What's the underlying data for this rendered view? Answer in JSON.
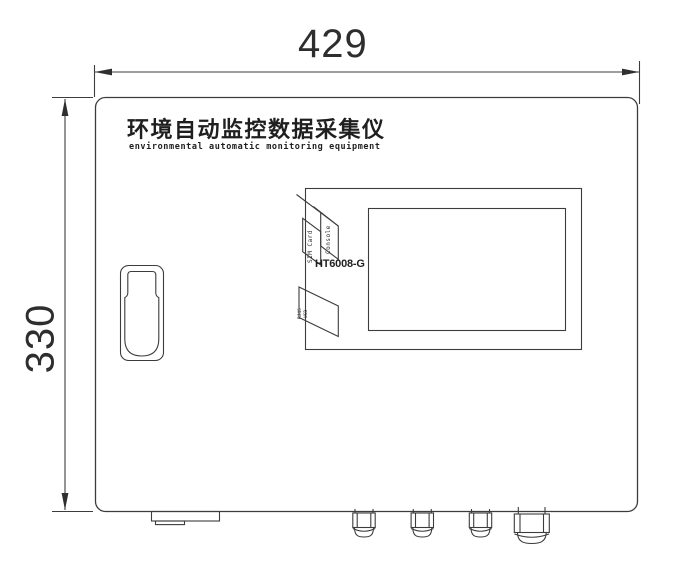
{
  "page": {
    "type": "technical-drawing",
    "subject": "enclosure front view"
  },
  "dimensions": {
    "width": "429",
    "height": "330"
  },
  "header": {
    "title_zh": "环境自动监控数据采集仪",
    "title_en": "environmental automatic monitoring equipment"
  },
  "device": {
    "model": "HT6008-G",
    "port_labels": {
      "console": "Console",
      "sim_card": "SIM Card",
      "rj45": "RJ45",
      "usb": "USB"
    }
  },
  "colors": {
    "line": "#3c3c3c",
    "text": "#2b2b2b",
    "background": "#ffffff"
  }
}
